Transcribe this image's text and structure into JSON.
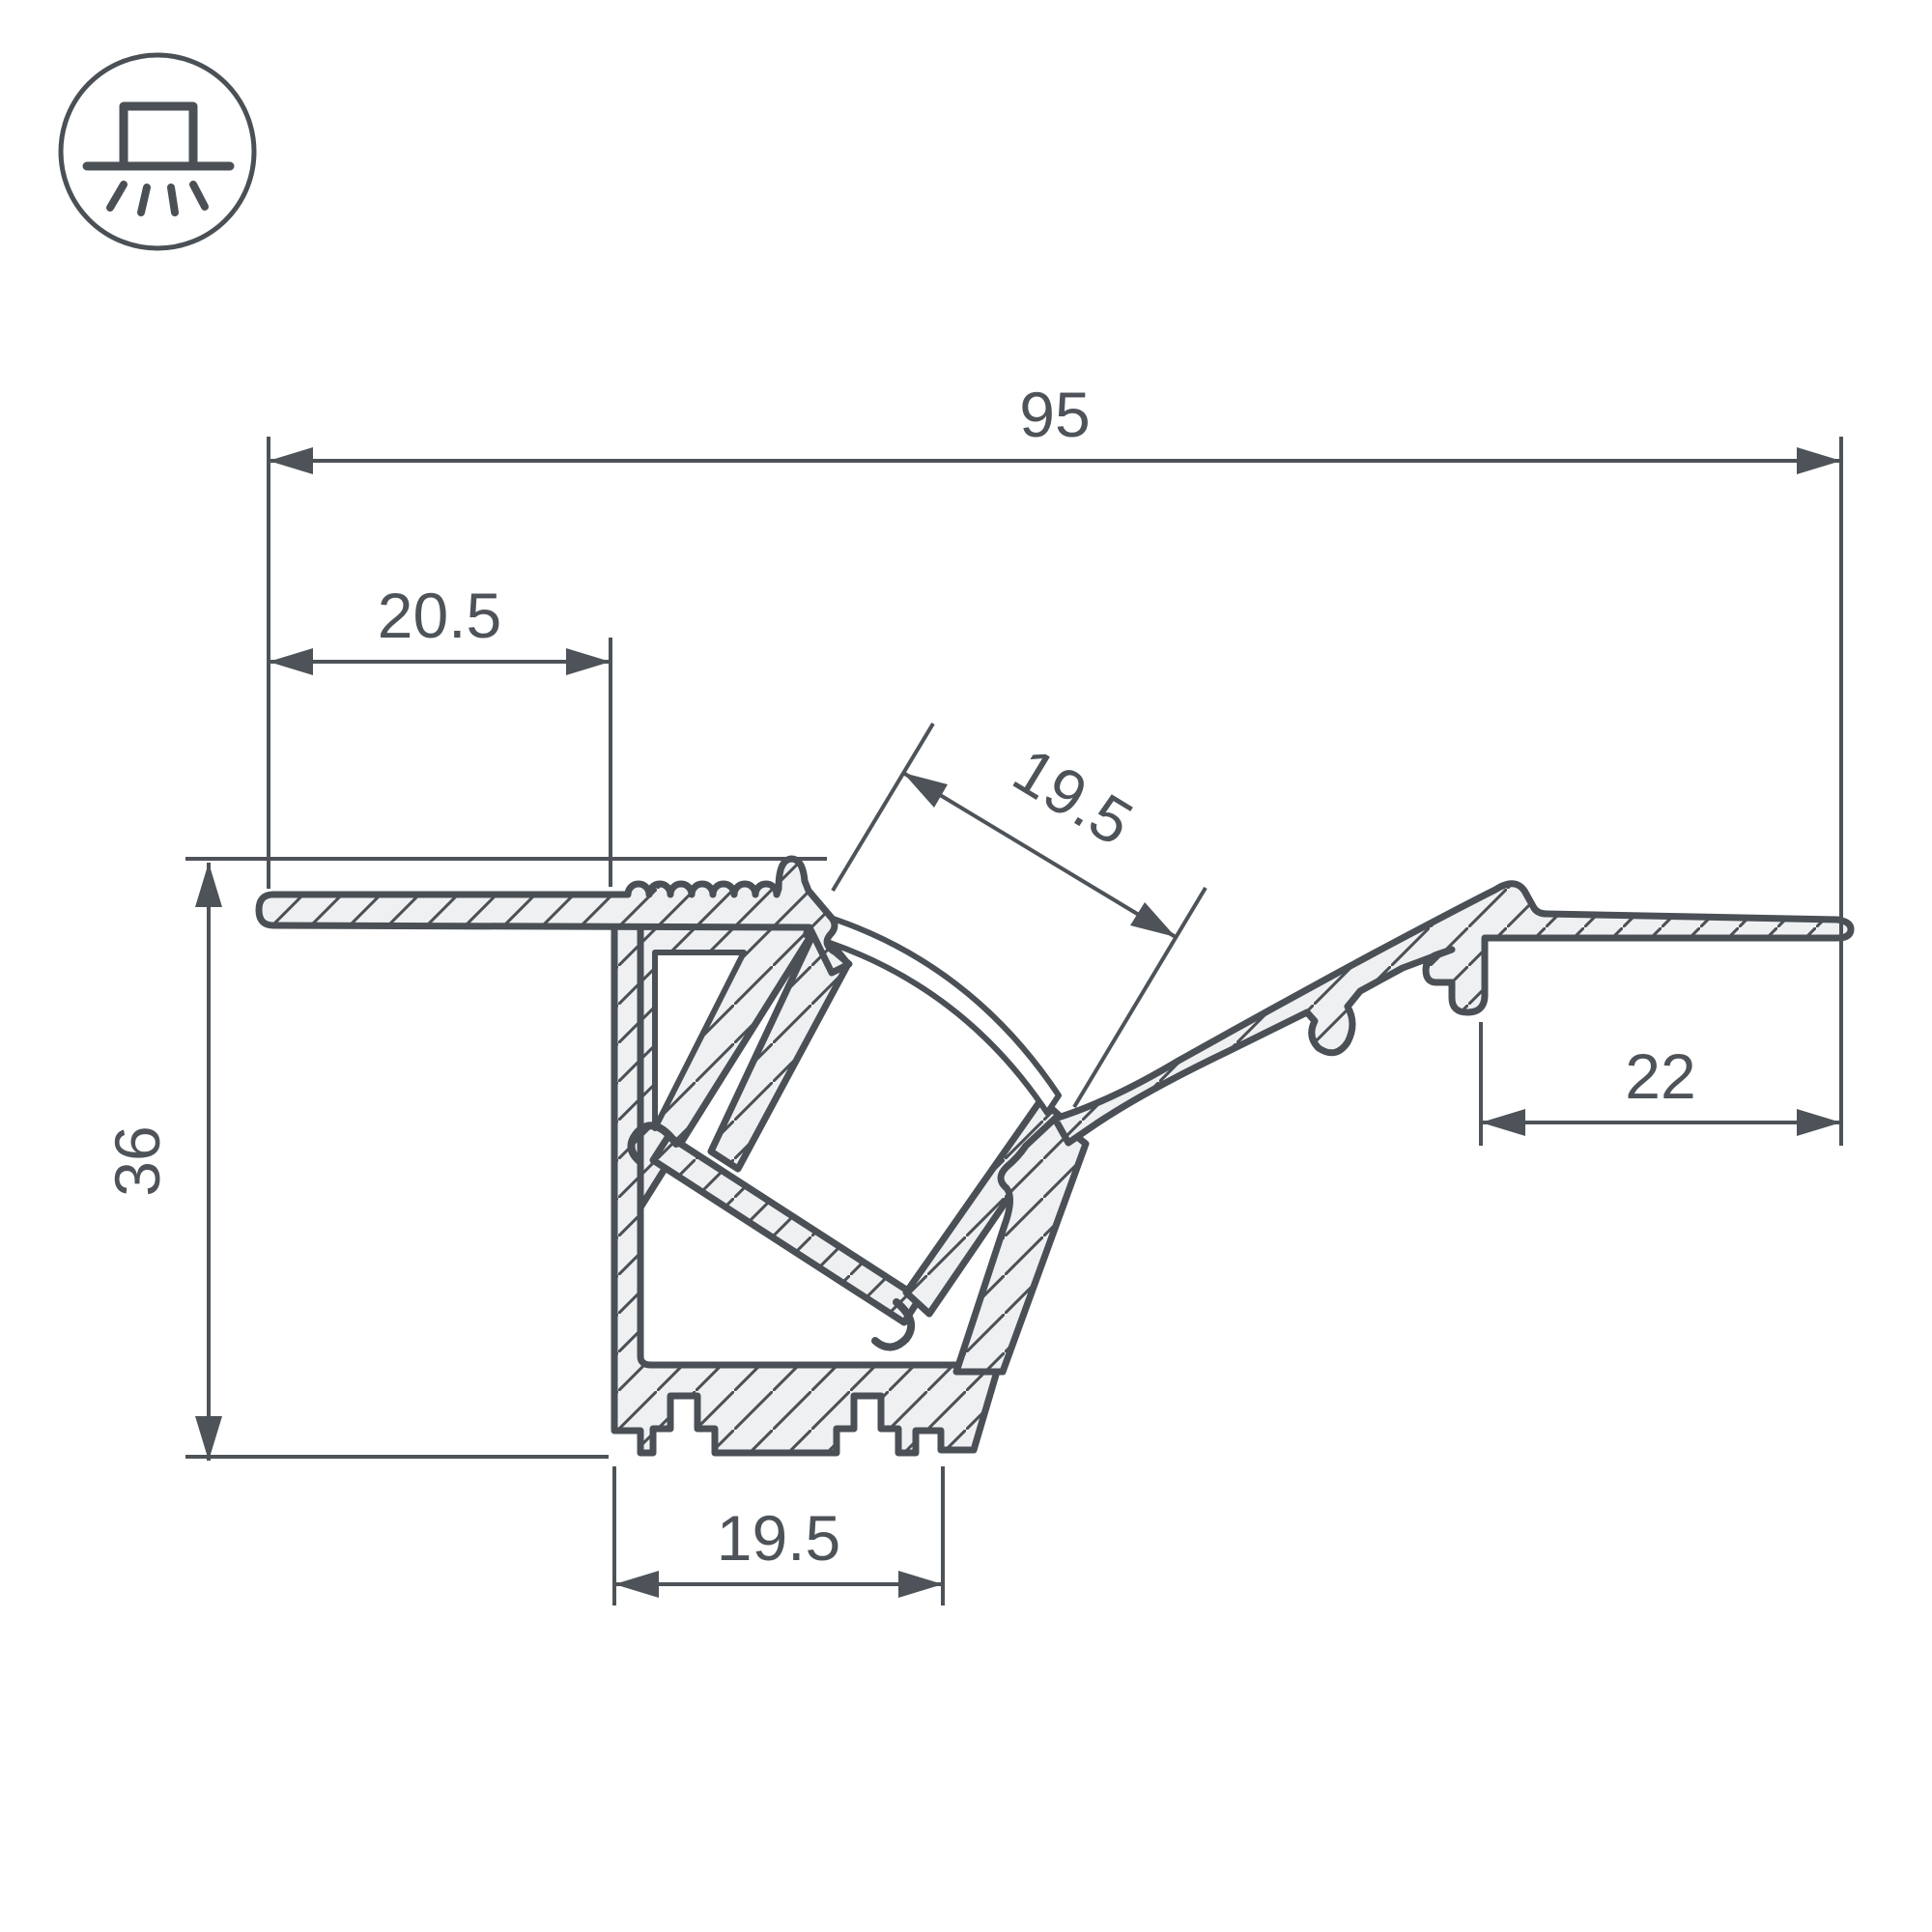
{
  "drawing": {
    "title": "LED profile cross-section technical drawing",
    "icon": {
      "name": "recessed-light-icon"
    },
    "dims": {
      "d95": {
        "label": "95"
      },
      "d205": {
        "label": "20.5"
      },
      "d19a": {
        "label": "19.5"
      },
      "d36": {
        "label": "36"
      },
      "d22": {
        "label": "22"
      },
      "d19b": {
        "label": "19.5"
      }
    },
    "colors": {
      "line": "#4a5055",
      "dimension": "#4d5358",
      "fill": "#eef0f1",
      "background": "#ffffff"
    }
  }
}
